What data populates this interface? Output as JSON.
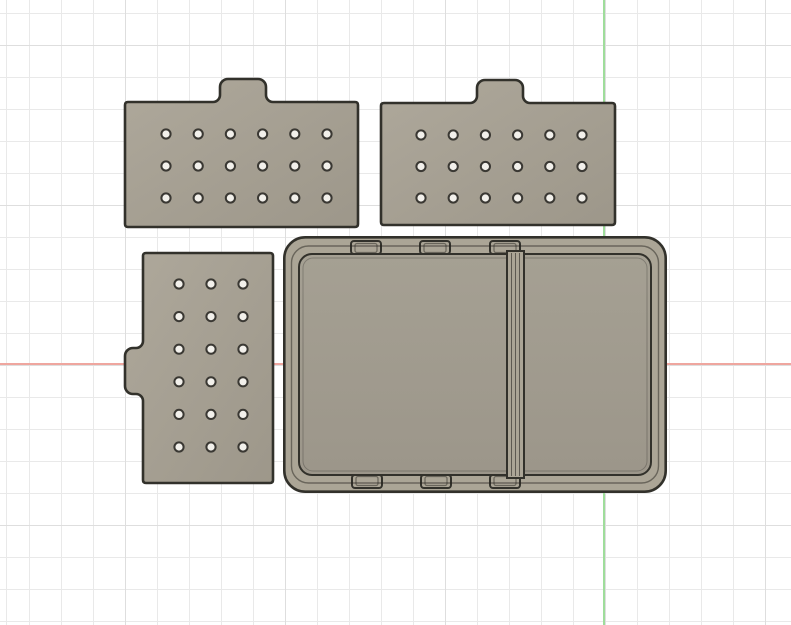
{
  "viewport": {
    "width": 791,
    "height": 625,
    "background": "#ffffff",
    "grid": {
      "minor_spacing": 32,
      "major_spacing": 160,
      "minor_offset_x": 29,
      "minor_offset_y": 13,
      "major_offset_x": 125,
      "major_offset_y": 45,
      "minor_color": "#e9e9e9",
      "major_color": "#dedede"
    },
    "axes": {
      "x_axis": {
        "y": 364,
        "color": "#efa69f",
        "thickness": 2
      },
      "y_axis": {
        "x": 604,
        "color": "#9fdd9b",
        "thickness": 2
      }
    }
  },
  "materials": {
    "face": "#a7a194",
    "face_light": "#aea89b",
    "face_dark": "#9d978a",
    "wall": "#aba596",
    "interior_top": "#a5a093",
    "interior_bottom": "#9c968a",
    "edge": "#32312b",
    "edge_soft": "rgba(40,38,32,0.5)",
    "hole_fill": "#f2f0eb",
    "hole_ring": "#3a3833"
  },
  "objects": [
    {
      "id": "lid-plate-top-left",
      "kind": "plate-top-tab",
      "x": 125,
      "y": 79,
      "plate_w": 233,
      "plate_h": 125,
      "tab": {
        "depth": 23,
        "center": 118,
        "top_w": 46,
        "top_r": 8,
        "fillet_r": 7
      },
      "holes": {
        "x0": 41,
        "y0": 55,
        "dx": 32.2,
        "dy": 32,
        "cols": 6,
        "rows": 3,
        "r": 4.6
      }
    },
    {
      "id": "lid-plate-top-right",
      "kind": "plate-top-tab",
      "x": 381,
      "y": 80,
      "plate_w": 234,
      "plate_h": 122,
      "tab": {
        "depth": 23,
        "center": 119,
        "top_w": 46,
        "top_r": 8,
        "fillet_r": 7
      },
      "holes": {
        "x0": 40,
        "y0": 55,
        "dx": 32.2,
        "dy": 31.5,
        "cols": 6,
        "rows": 3,
        "r": 4.6
      }
    },
    {
      "id": "lid-plate-bottom-left",
      "kind": "plate-left-tab",
      "x": 125,
      "y": 253,
      "plate_w": 130,
      "plate_h": 230,
      "tab": {
        "depth": 18,
        "center": 118,
        "top_w": 46,
        "top_r": 8,
        "fillet_r": 7
      },
      "holes": {
        "x0": 54,
        "y0": 31,
        "dx": 32,
        "dy": 32.6,
        "cols": 3,
        "rows": 6,
        "r": 4.6
      }
    },
    {
      "id": "divided-box",
      "kind": "box",
      "x": 283,
      "y": 236,
      "w": 384,
      "h": 257,
      "corner_r": 21,
      "rim_inset": 8.5,
      "rim_r": 17,
      "floor_inset": 16,
      "floor_r": 13,
      "chamfer_inset": 20,
      "chamfer_r": 10,
      "divider": {
        "x1": 224,
        "x2": 241,
        "end_inset": 15,
        "inner_lines": [
          228.5,
          232.5,
          236.5
        ]
      },
      "clips": {
        "w": 30,
        "h": 13,
        "corner_r": 3,
        "top_y": 5,
        "bottom_margin": 18,
        "top_centers": [
          83,
          152,
          222
        ],
        "bottom_centers": [
          84,
          153,
          222
        ]
      }
    }
  ]
}
